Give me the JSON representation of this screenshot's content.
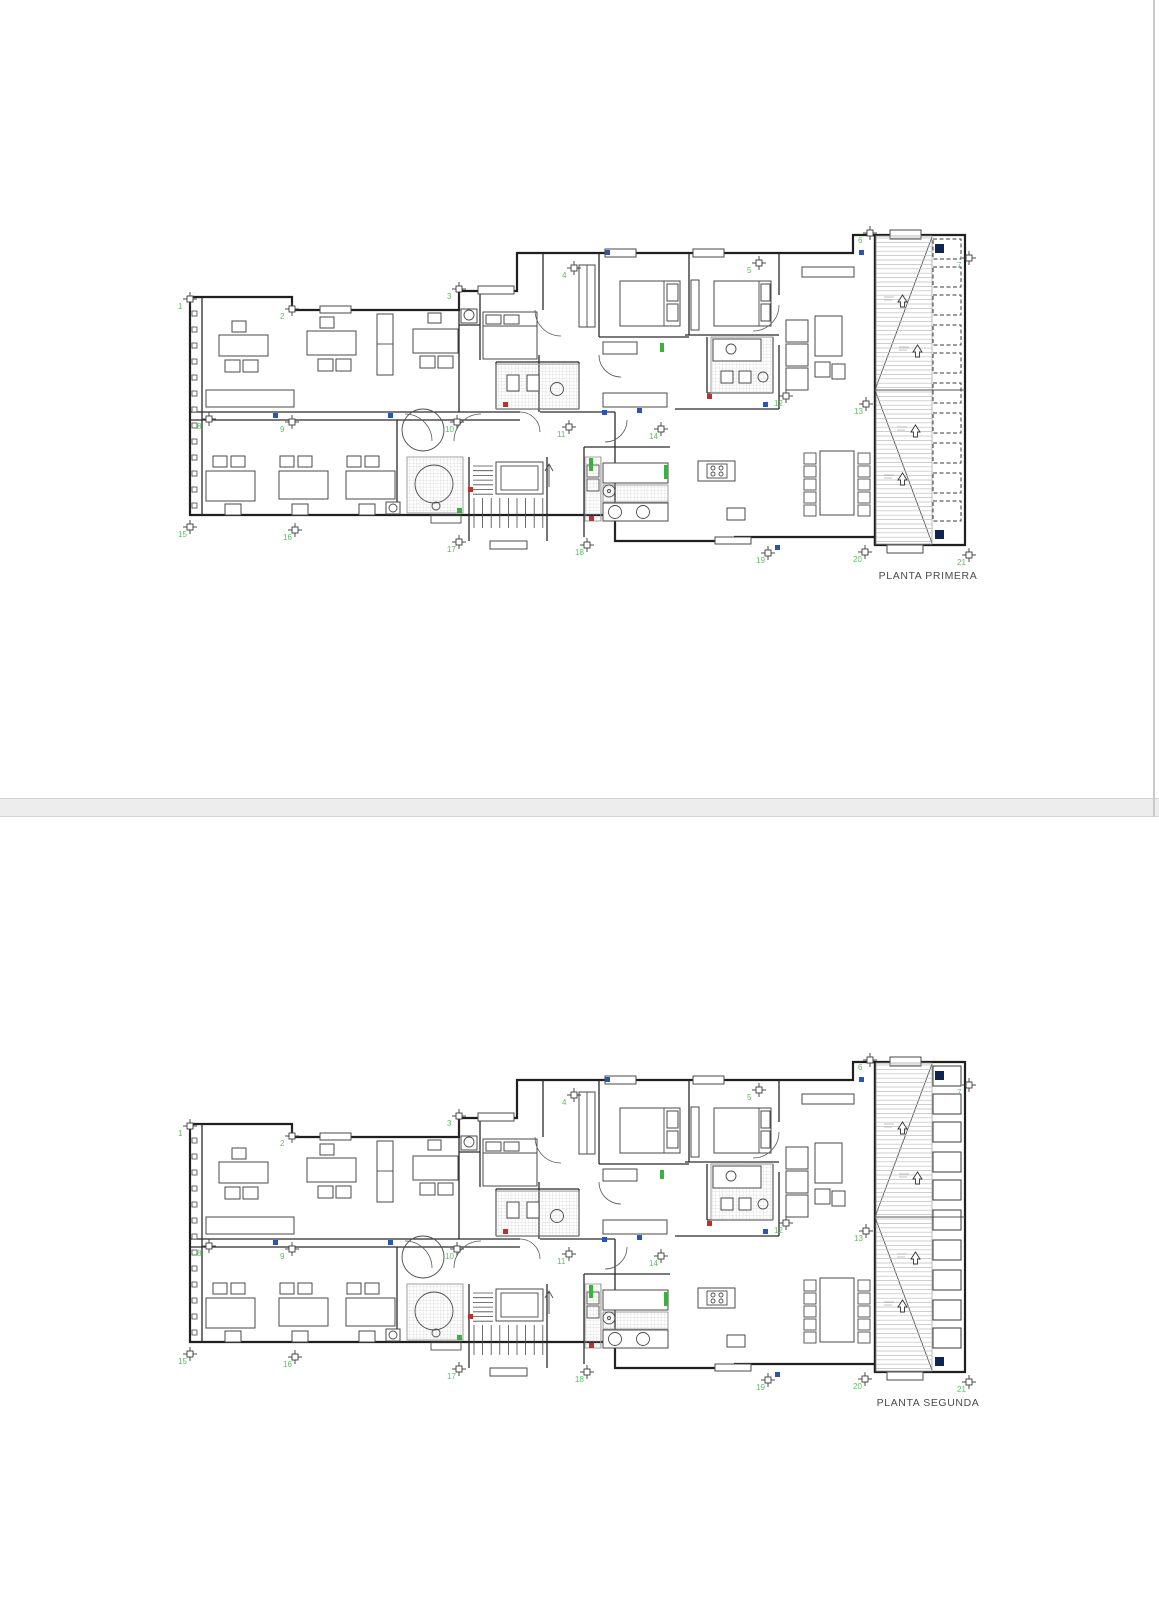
{
  "page": {
    "width": 1159,
    "height": 1600,
    "background": "#ffffff"
  },
  "plans": [
    {
      "id": "planta-primera",
      "label": "PLANTA PRIMERA",
      "planter_style": "dashed"
    },
    {
      "id": "planta-segunda",
      "label": "PLANTA SEGUNDA",
      "planter_style": "solid"
    }
  ],
  "markers": {
    "color": "#5cc25c",
    "points": [
      {
        "n": "1",
        "x": 15,
        "y": 74
      },
      {
        "n": "2",
        "x": 117,
        "y": 84
      },
      {
        "n": "3",
        "x": 284,
        "y": 64
      },
      {
        "n": "4",
        "x": 399,
        "y": 43
      },
      {
        "n": "5",
        "x": 584,
        "y": 38
      },
      {
        "n": "6",
        "x": 695,
        "y": 8
      },
      {
        "n": "7",
        "x": 794,
        "y": 33
      },
      {
        "n": "8",
        "x": 34,
        "y": 194
      },
      {
        "n": "9",
        "x": 117,
        "y": 197
      },
      {
        "n": "10",
        "x": 282,
        "y": 197
      },
      {
        "n": "11",
        "x": 394,
        "y": 202
      },
      {
        "n": "12",
        "x": 611,
        "y": 171
      },
      {
        "n": "13",
        "x": 691,
        "y": 179
      },
      {
        "n": "14",
        "x": 486,
        "y": 204
      },
      {
        "n": "15",
        "x": 15,
        "y": 302
      },
      {
        "n": "16",
        "x": 120,
        "y": 305
      },
      {
        "n": "17",
        "x": 284,
        "y": 317
      },
      {
        "n": "18",
        "x": 412,
        "y": 320
      },
      {
        "n": "19",
        "x": 593,
        "y": 328
      },
      {
        "n": "20",
        "x": 690,
        "y": 327
      },
      {
        "n": "21",
        "x": 794,
        "y": 330
      }
    ]
  },
  "colors": {
    "wall": "#1f1f1f",
    "furniture": "#4a4a4a",
    "hatch": "#c4c4c4",
    "deck_line": "#bdbdbd",
    "accent_blue": "#2457b8",
    "accent_navy": "#0d2550",
    "accent_red": "#c03028",
    "accent_green": "#38b23c",
    "marker_green": "#5cc25c",
    "label_text": "#4a4a4a",
    "divider": "#ededed",
    "edge_line": "#cbcbcb"
  }
}
